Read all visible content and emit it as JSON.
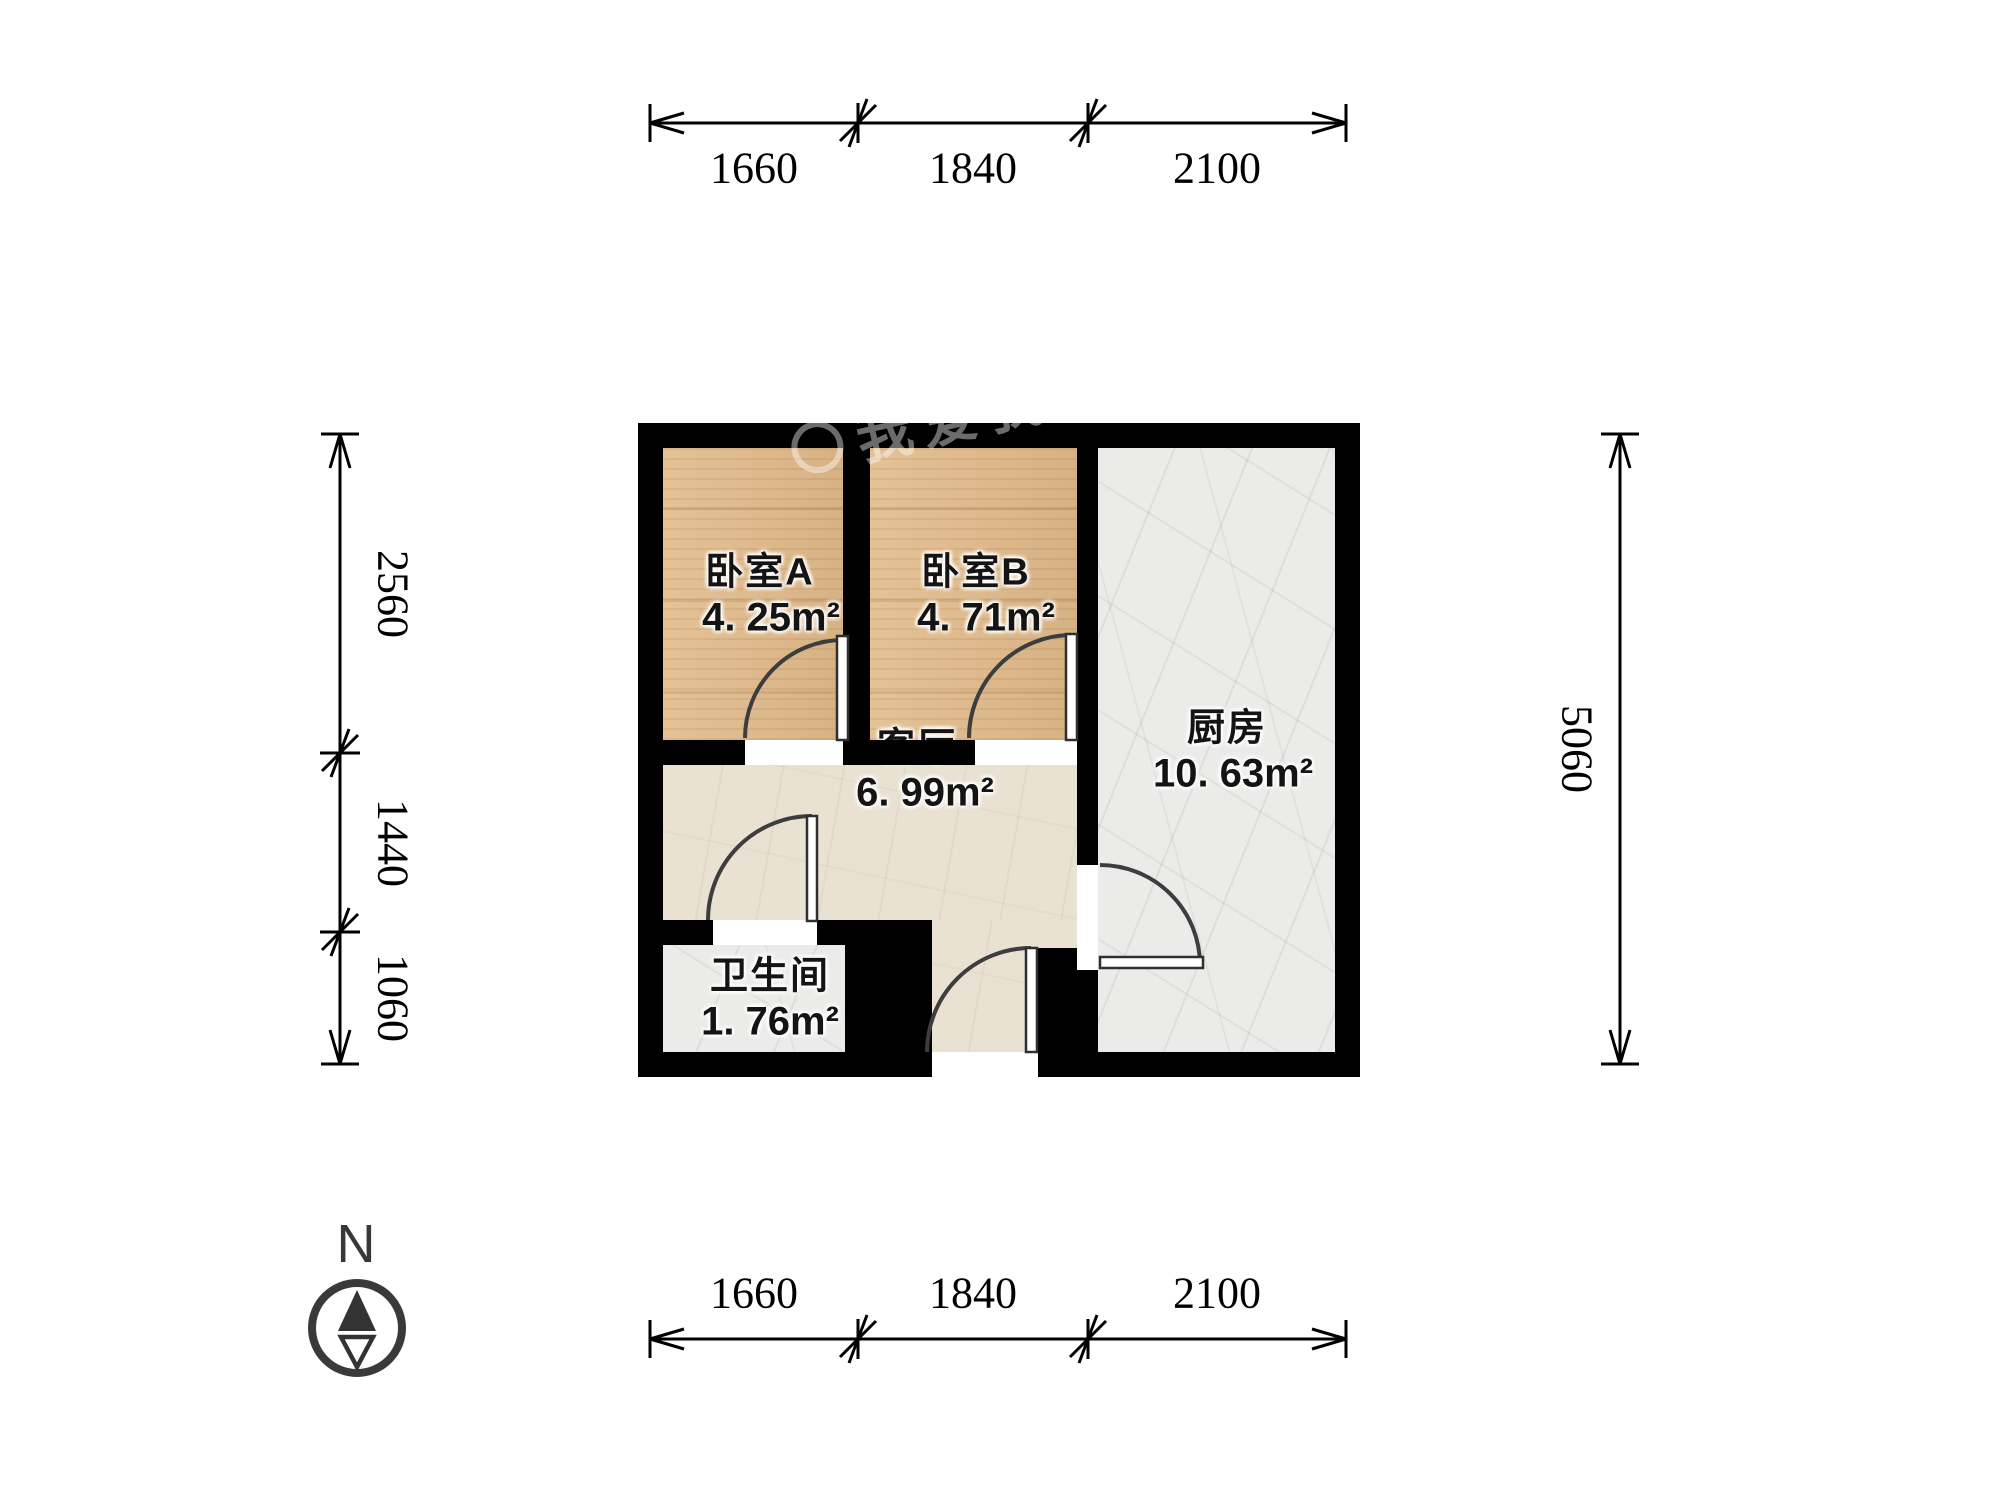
{
  "watermark": {
    "text": "我爱我家"
  },
  "compass": {
    "label": "N"
  },
  "rooms": {
    "bedroomA": {
      "name": "卧室A",
      "area": "4. 25m²"
    },
    "bedroomB": {
      "name": "卧室B",
      "area": "4. 71m²"
    },
    "kitchen": {
      "name": "厨房",
      "area": "10. 63m²"
    },
    "living": {
      "name": "客厅",
      "area": "6. 99m²"
    },
    "bathroom": {
      "name": "卫生间",
      "area": "1. 76m²"
    }
  },
  "dimensions": {
    "top": [
      "1660",
      "1840",
      "2100"
    ],
    "bottom": [
      "1660",
      "1840",
      "2100"
    ],
    "left": [
      "2560",
      "1440",
      "1060"
    ],
    "right": [
      "5060"
    ]
  }
}
